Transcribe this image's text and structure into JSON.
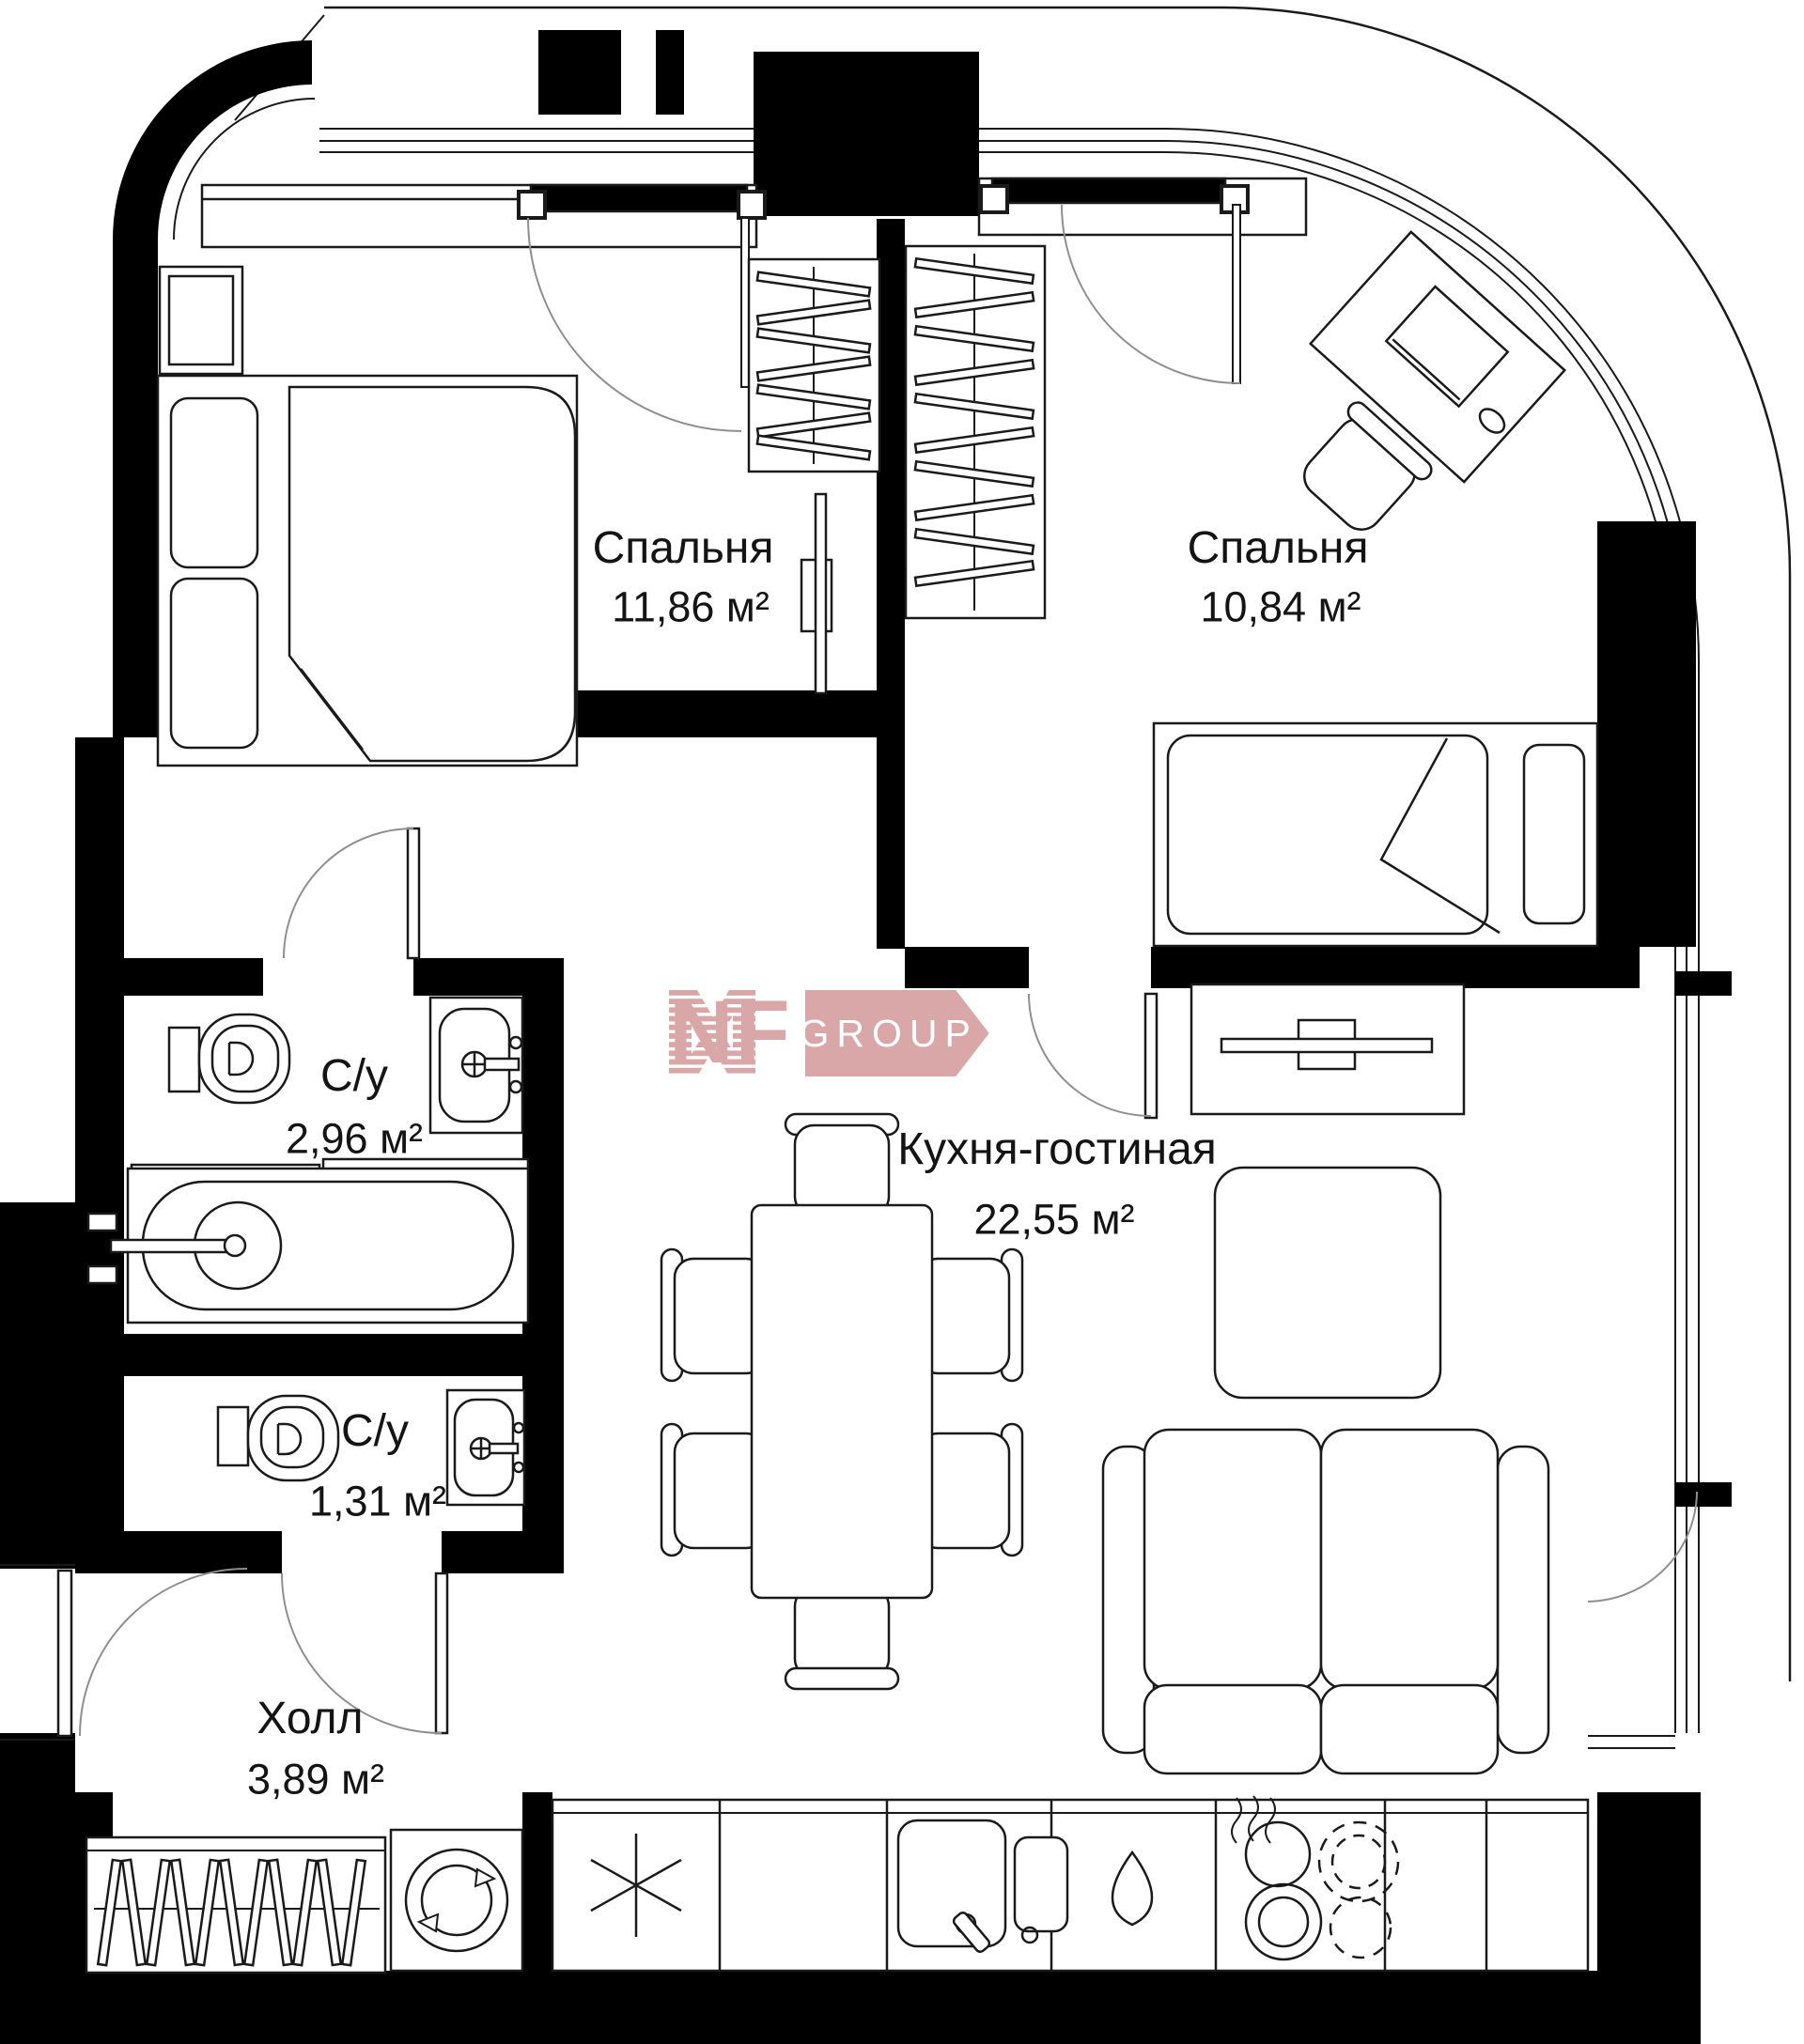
{
  "plan": {
    "rooms": [
      {
        "id": "bedroom-1",
        "name": "Спальня",
        "area": "11,86 м²"
      },
      {
        "id": "bedroom-2",
        "name": "Спальня",
        "area": "10,84 м²"
      },
      {
        "id": "bathroom-1",
        "name": "С/у",
        "area": "2,96 м²"
      },
      {
        "id": "bathroom-2",
        "name": "С/у",
        "area": "1,31 м²"
      },
      {
        "id": "kitchen-living",
        "name": "Кухня-гостиная",
        "area": "22,55 м²"
      },
      {
        "id": "hall",
        "name": "Холл",
        "area": "3,89 м²"
      }
    ],
    "watermark": {
      "brand": "NF",
      "suffix": "GROUP",
      "color": "#d9a7a7"
    },
    "colors": {
      "walls": "#000000",
      "lines": "#1a1a1a",
      "door_arcs": "#8f8f8f",
      "background": "#ffffff",
      "text": "#141414"
    },
    "icons": [
      "double-bed-icon",
      "single-bed-icon",
      "wardrobe-hangers-icon",
      "toilet-icon",
      "sink-icon",
      "bathtub-icon",
      "washing-machine-icon",
      "fridge-snowflake-icon",
      "kitchen-sink-icon",
      "water-drop-icon",
      "hob-burners-icon",
      "dining-table-icon",
      "chair-icon",
      "sofa-icon",
      "tv-icon",
      "tv-console-icon",
      "desk-icon",
      "rug-icon",
      "door-swing-icon"
    ]
  }
}
